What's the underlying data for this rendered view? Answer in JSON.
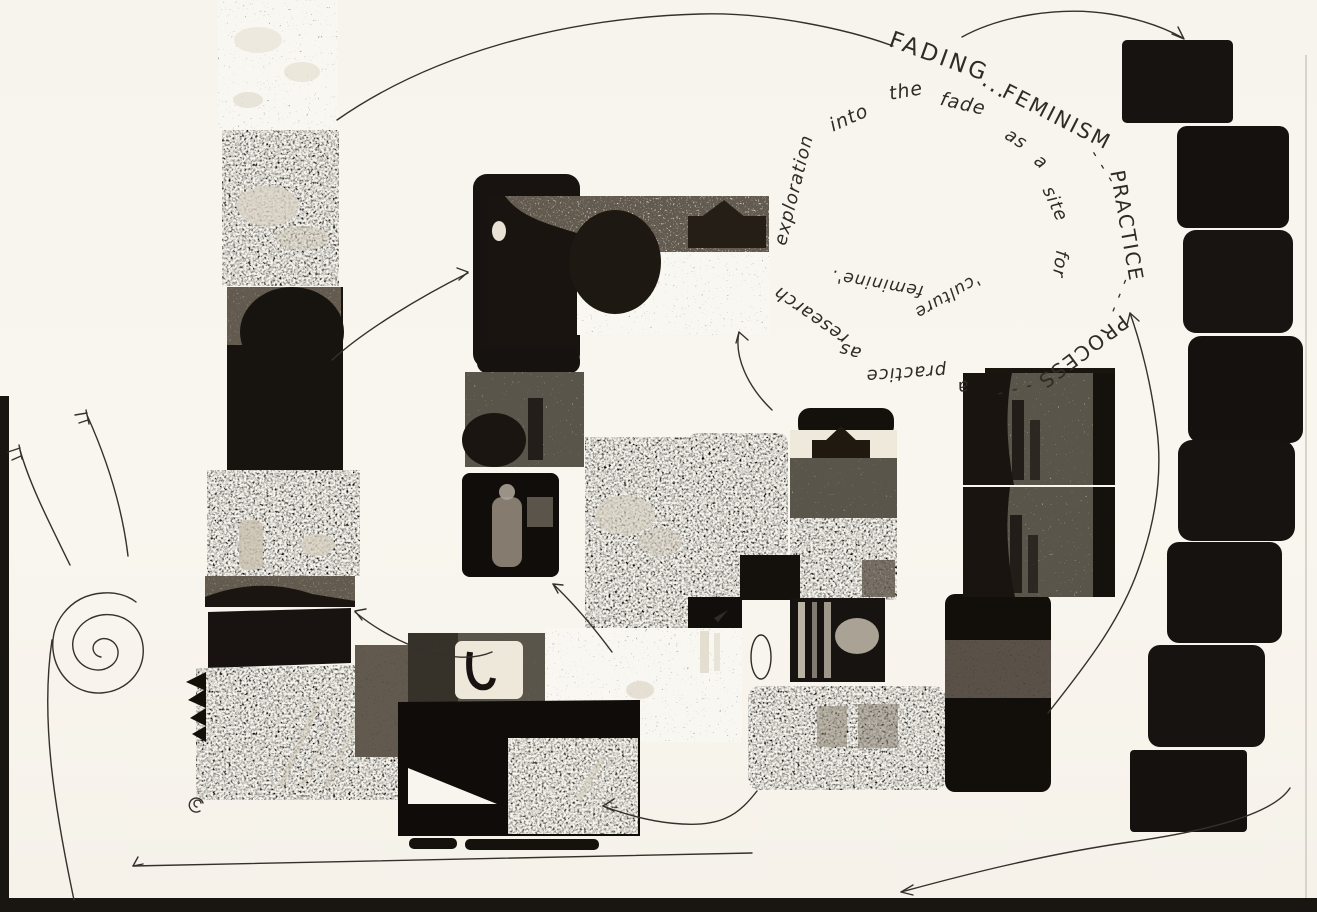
{
  "page": {
    "kind": "scanned research collage page",
    "paper_color": "#f8f5ee",
    "ink_color": "#2f2b25"
  },
  "handwriting": {
    "full_phrase": "FADING ... FEMINISM --- PRACTICE --- PROCESS --- a practice as research exploration into the fade as a site for 'culture feminine'.",
    "words": [
      {
        "text": "FADING"
      },
      {
        "text": "..."
      },
      {
        "text": "FEMINISM"
      },
      {
        "text": "- - -"
      },
      {
        "text": "PRACTICE"
      },
      {
        "text": "- - -"
      },
      {
        "text": "PROCESS"
      },
      {
        "text": "- - -"
      },
      {
        "text": "a"
      },
      {
        "text": "practice"
      },
      {
        "text": "as"
      },
      {
        "text": "research"
      },
      {
        "text": "exploration"
      },
      {
        "text": "into"
      },
      {
        "text": "the"
      },
      {
        "text": "fade"
      },
      {
        "text": "as"
      },
      {
        "text": "a"
      },
      {
        "text": "site"
      },
      {
        "text": "for"
      },
      {
        "text": "'culture"
      },
      {
        "text": "feminine'."
      }
    ]
  },
  "doodles": {
    "names": [
      "snail-doodle",
      "spiral-loop-doodle",
      "oval-outline-doodle",
      "f-tick-marks",
      "hand-drawn-arrows"
    ]
  },
  "photos": {
    "left_strip": [
      "statue-texture",
      "sleeping-face",
      "head-silhouette",
      "dark-stage-figure",
      "grainy-hill-strip",
      "dark-wedge",
      "bookshelf-block"
    ],
    "center_cluster": [
      "slide-bent-figure",
      "field-with-house",
      "crowd-texture",
      "figure-in-dark-room",
      "mountain-dark",
      "tall-dark-slide",
      "house-on-hill",
      "striped-frames",
      "dark-slide-pair",
      "stacked-street-scenes",
      "car-window",
      "busy-street",
      "dark-mass",
      "film-strips"
    ],
    "right_column_count": 8
  }
}
